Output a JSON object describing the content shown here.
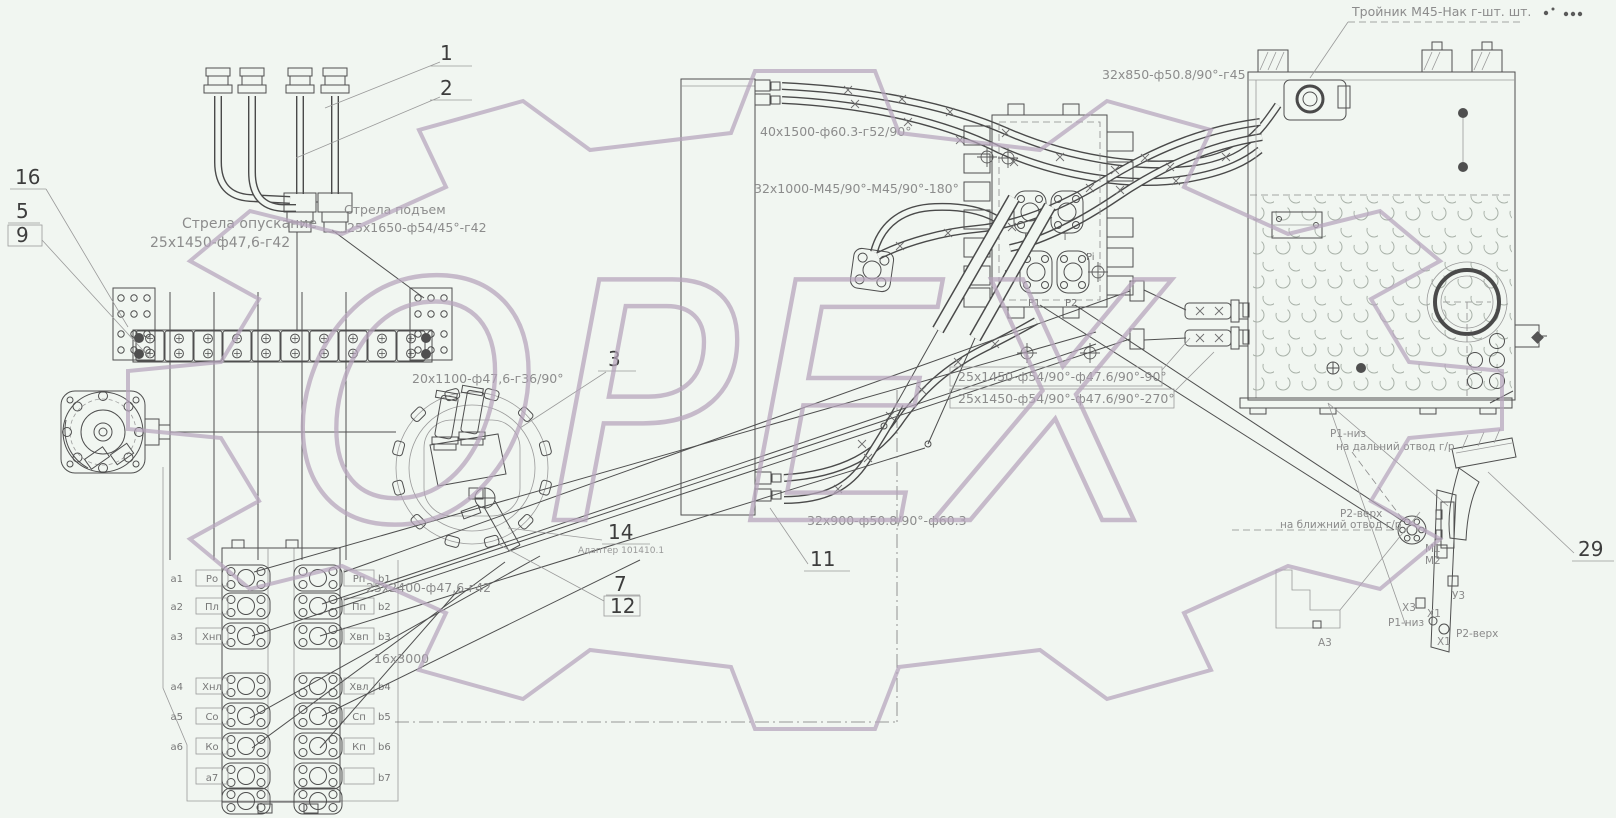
{
  "colors": {
    "background": "#f1f6f1",
    "ink": "#4a4a4a",
    "muted": "#8c8c8c",
    "watermark": "#b6a4bc"
  },
  "watermark": {
    "text": "ОРЕХ"
  },
  "callouts": {
    "n1": "1",
    "n2": "2",
    "n3": "3",
    "n5": "5",
    "n7": "7",
    "n9": "9",
    "n11": "11",
    "n12": "12",
    "n14": "14",
    "n16": "16",
    "n29": "29"
  },
  "labels": {
    "troynik": "Тройник М45-Нак г-шт. шт.",
    "boom_lower_name": "Стрела опускание",
    "boom_lower_spec": "25х1450-ф47,6-г42",
    "boom_raise_name": "Стрела подъем",
    "boom_raise_spec": "25х1650-ф54/45°-г42",
    "hose_40_1500": "40х1500-ф60.3-г52/90°",
    "hose_32_1000": "32х1000-М45/90°-М45/90°-180°",
    "hose_32_850": "32х850-ф50.8/90°-г45",
    "hose_25_1450_90": "25х1450-ф54/90°-ф47.6/90°-90°",
    "hose_25_1450_270": "25х1450-ф54/90°-ф47.6/90°-270°",
    "hose_32_900": "32х900-ф50.8/90°-ф60.3",
    "hose_20_1100": "20х1100-ф47,6-г36/90°",
    "hose_25_2400": "25х2400-ф47,6-г42",
    "hose_16_3000": "16х3000",
    "adapter": "Адаптер 101410.1",
    "p1_low": "Р1-низ",
    "p1_low_note": "на дальний отвод г/р",
    "p2_top": "Р2-верх",
    "p2_top_note": "на ближний отвод г/р",
    "m1": "М1",
    "m2": "М2",
    "u3": "У3",
    "x3": "Х3",
    "x1_a": "Х1",
    "x1_b": "Х1",
    "p1_low_b": "Р1-низ",
    "p2_top_b": "Р2-верх",
    "a3": "А3"
  },
  "block_ports": {
    "k": "K",
    "t": "T",
    "l1": "L1",
    "pi": "Pi",
    "p1": "Р1",
    "p2": "Р2"
  },
  "valve_bank": {
    "left": [
      {
        "pre": "a1",
        "label": "Ро"
      },
      {
        "pre": "a2",
        "label": "Пл"
      },
      {
        "pre": "a3",
        "label": "Хнп"
      },
      {
        "pre": "a4",
        "label": "Хнл"
      },
      {
        "pre": "a5",
        "label": "Со"
      },
      {
        "pre": "a6",
        "label": "Ко"
      },
      {
        "pre": "a7",
        "label": ""
      }
    ],
    "right": [
      {
        "suf": "b1",
        "label": "Рп"
      },
      {
        "suf": "b2",
        "label": "Пп"
      },
      {
        "suf": "b3",
        "label": "Хвп"
      },
      {
        "suf": "b4",
        "label": "Хвл"
      },
      {
        "suf": "b5",
        "label": "Сп"
      },
      {
        "suf": "b6",
        "label": "Кп"
      },
      {
        "suf": "b7",
        "label": ""
      }
    ]
  }
}
